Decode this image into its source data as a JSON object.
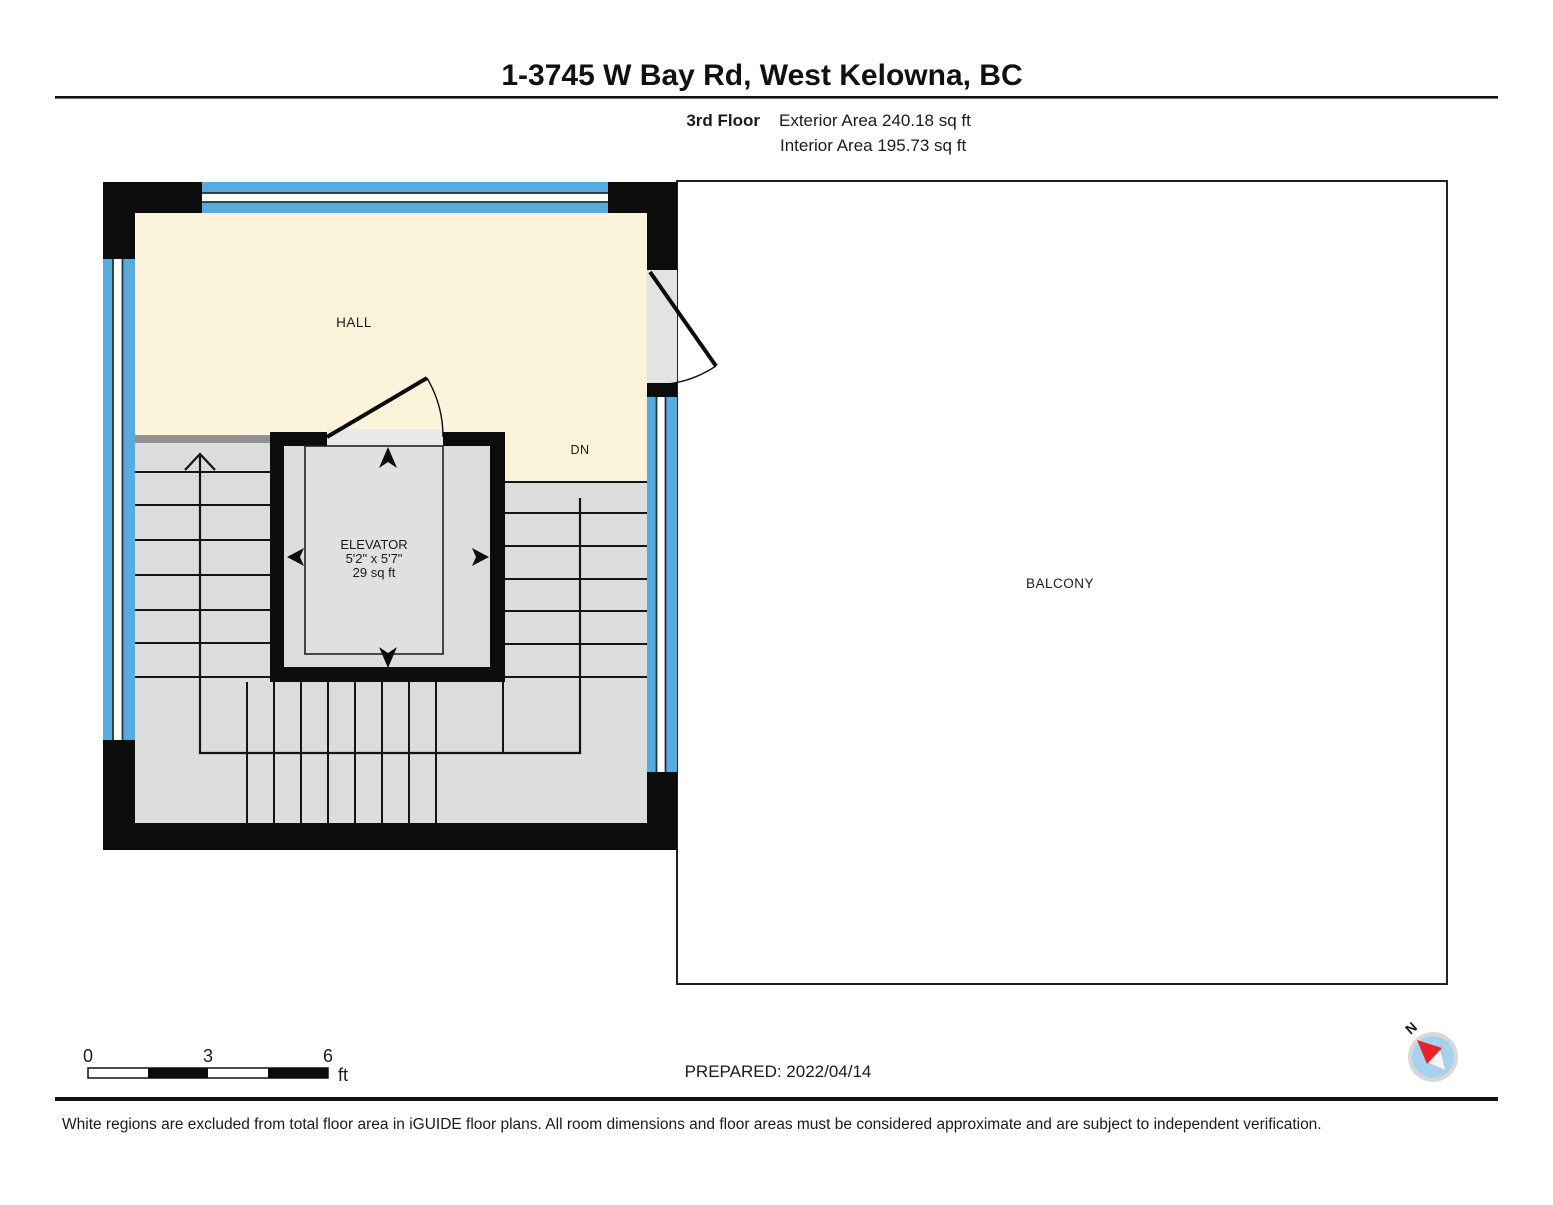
{
  "header": {
    "title": "1-3745 W Bay Rd, West Kelowna, BC",
    "floor_label": "3rd Floor",
    "exterior_area": "Exterior Area 240.18 sq ft",
    "interior_area": "Interior Area 195.73 sq ft"
  },
  "plan": {
    "labels": {
      "hall": "HALL",
      "dn": "DN",
      "elevator": "ELEVATOR",
      "elevator_dims": "5'2\" x 5'7\"",
      "elevator_area": "29 sq ft",
      "balcony": "BALCONY"
    }
  },
  "scale_bar": {
    "tick_0": "0",
    "tick_3": "3",
    "tick_6": "6",
    "unit": "ft"
  },
  "compass": {
    "north": "N"
  },
  "footer": {
    "prepared": "PREPARED: 2022/04/14",
    "disclaimer": "White regions are excluded from total floor area in iGUIDE floor plans. All room dimensions and floor areas must be considered approximate and are subject to independent verification."
  },
  "colors": {
    "window_blue": "#57acdf",
    "interior_cream": "#fbf3da",
    "stair_gray": "#dcdcdc",
    "opening_gray": "#e9e9e9",
    "wall_black": "#0c0c0c",
    "compass_blue": "#a5d2ee",
    "compass_needle_red": "#e8212d"
  }
}
